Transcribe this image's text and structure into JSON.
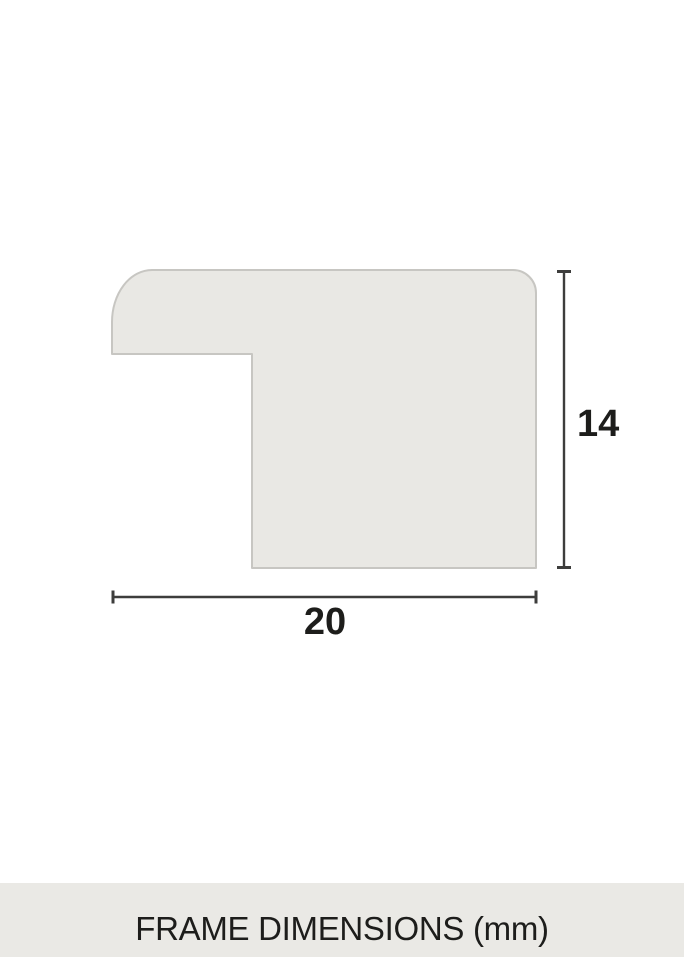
{
  "diagram": {
    "title": "frame-moulding-profile-cross-section",
    "shape": {
      "fill": "#e9e8e4",
      "stroke": "#c7c6c2"
    },
    "dimensions": {
      "height": {
        "value": "14",
        "unit": "mm"
      },
      "width": {
        "value": "20",
        "unit": "mm"
      }
    },
    "dimension_line_color": "#3d3d3c",
    "label_color": "#1d1d1b"
  },
  "footer": {
    "caption": "FRAME DIMENSIONS (mm)",
    "background": "#eae9e5",
    "text_color": "#1d1d1b"
  }
}
